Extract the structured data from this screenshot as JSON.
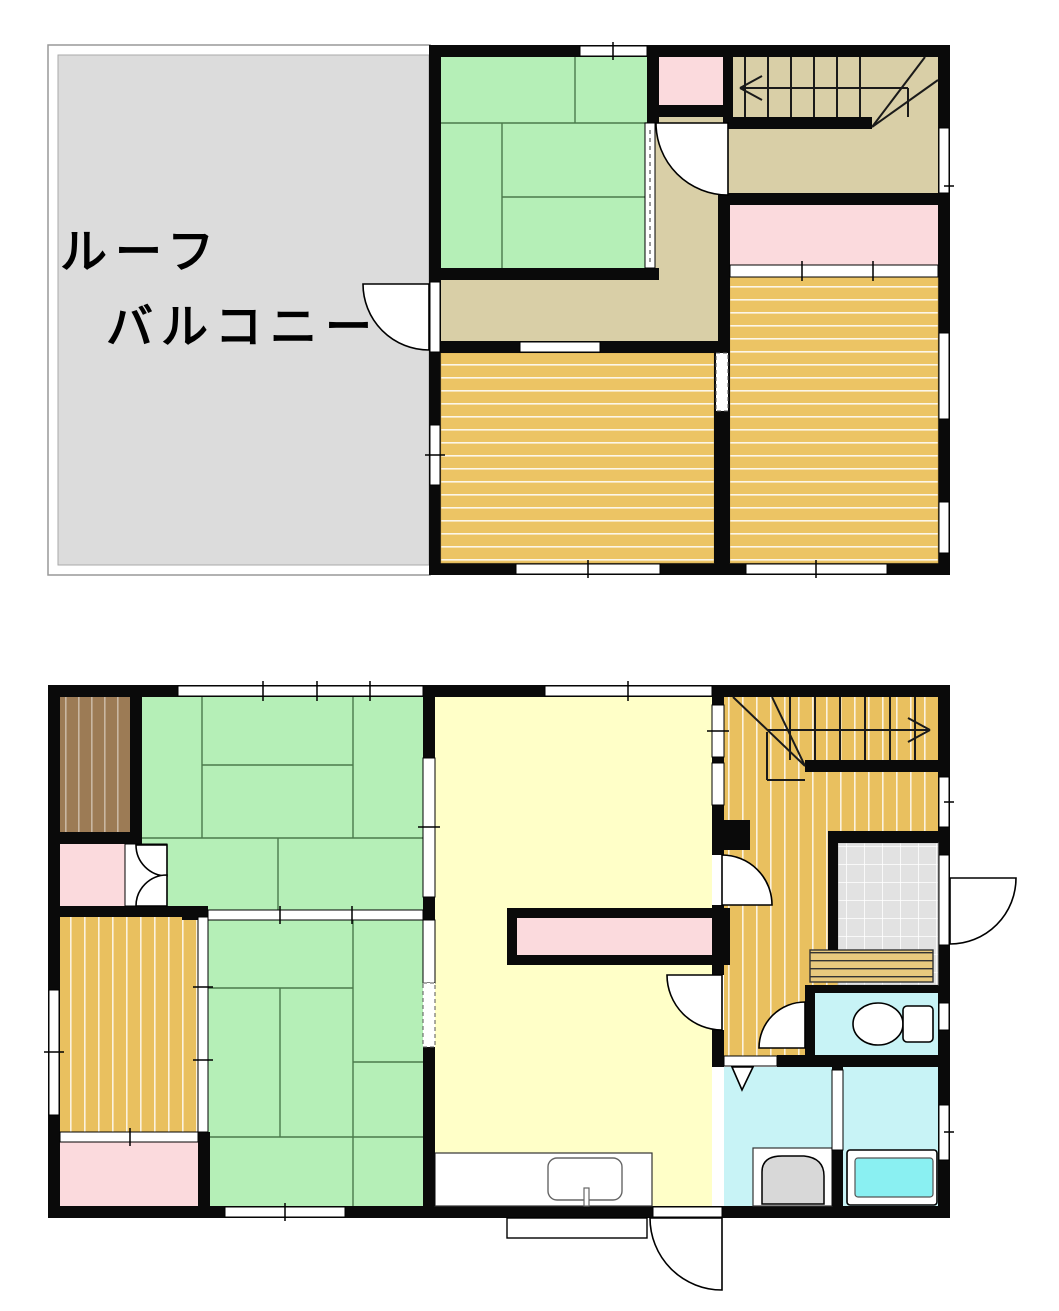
{
  "balcony": {
    "line1": "ルーフ",
    "line2": "バルコニー"
  },
  "palette": {
    "wall_black": "#0a0a0a",
    "tatami_green": "#b5efb7",
    "tatami_line": "#4b7a4b",
    "wood_floor": "#ecc464",
    "hallway_tan": "#d9cfa7",
    "closet_pink": "#fbdadd",
    "balcony_gray": "#dcdcdc",
    "ldk_yellow": "#ffffc8",
    "wet_area_cyan": "#c8f3f6",
    "bathtub_cyan": "#8af0f2",
    "storage_brown": "#9c7b55",
    "tile_gray": "#e2e2e2",
    "fixture_gray": "#d8d8d8"
  }
}
